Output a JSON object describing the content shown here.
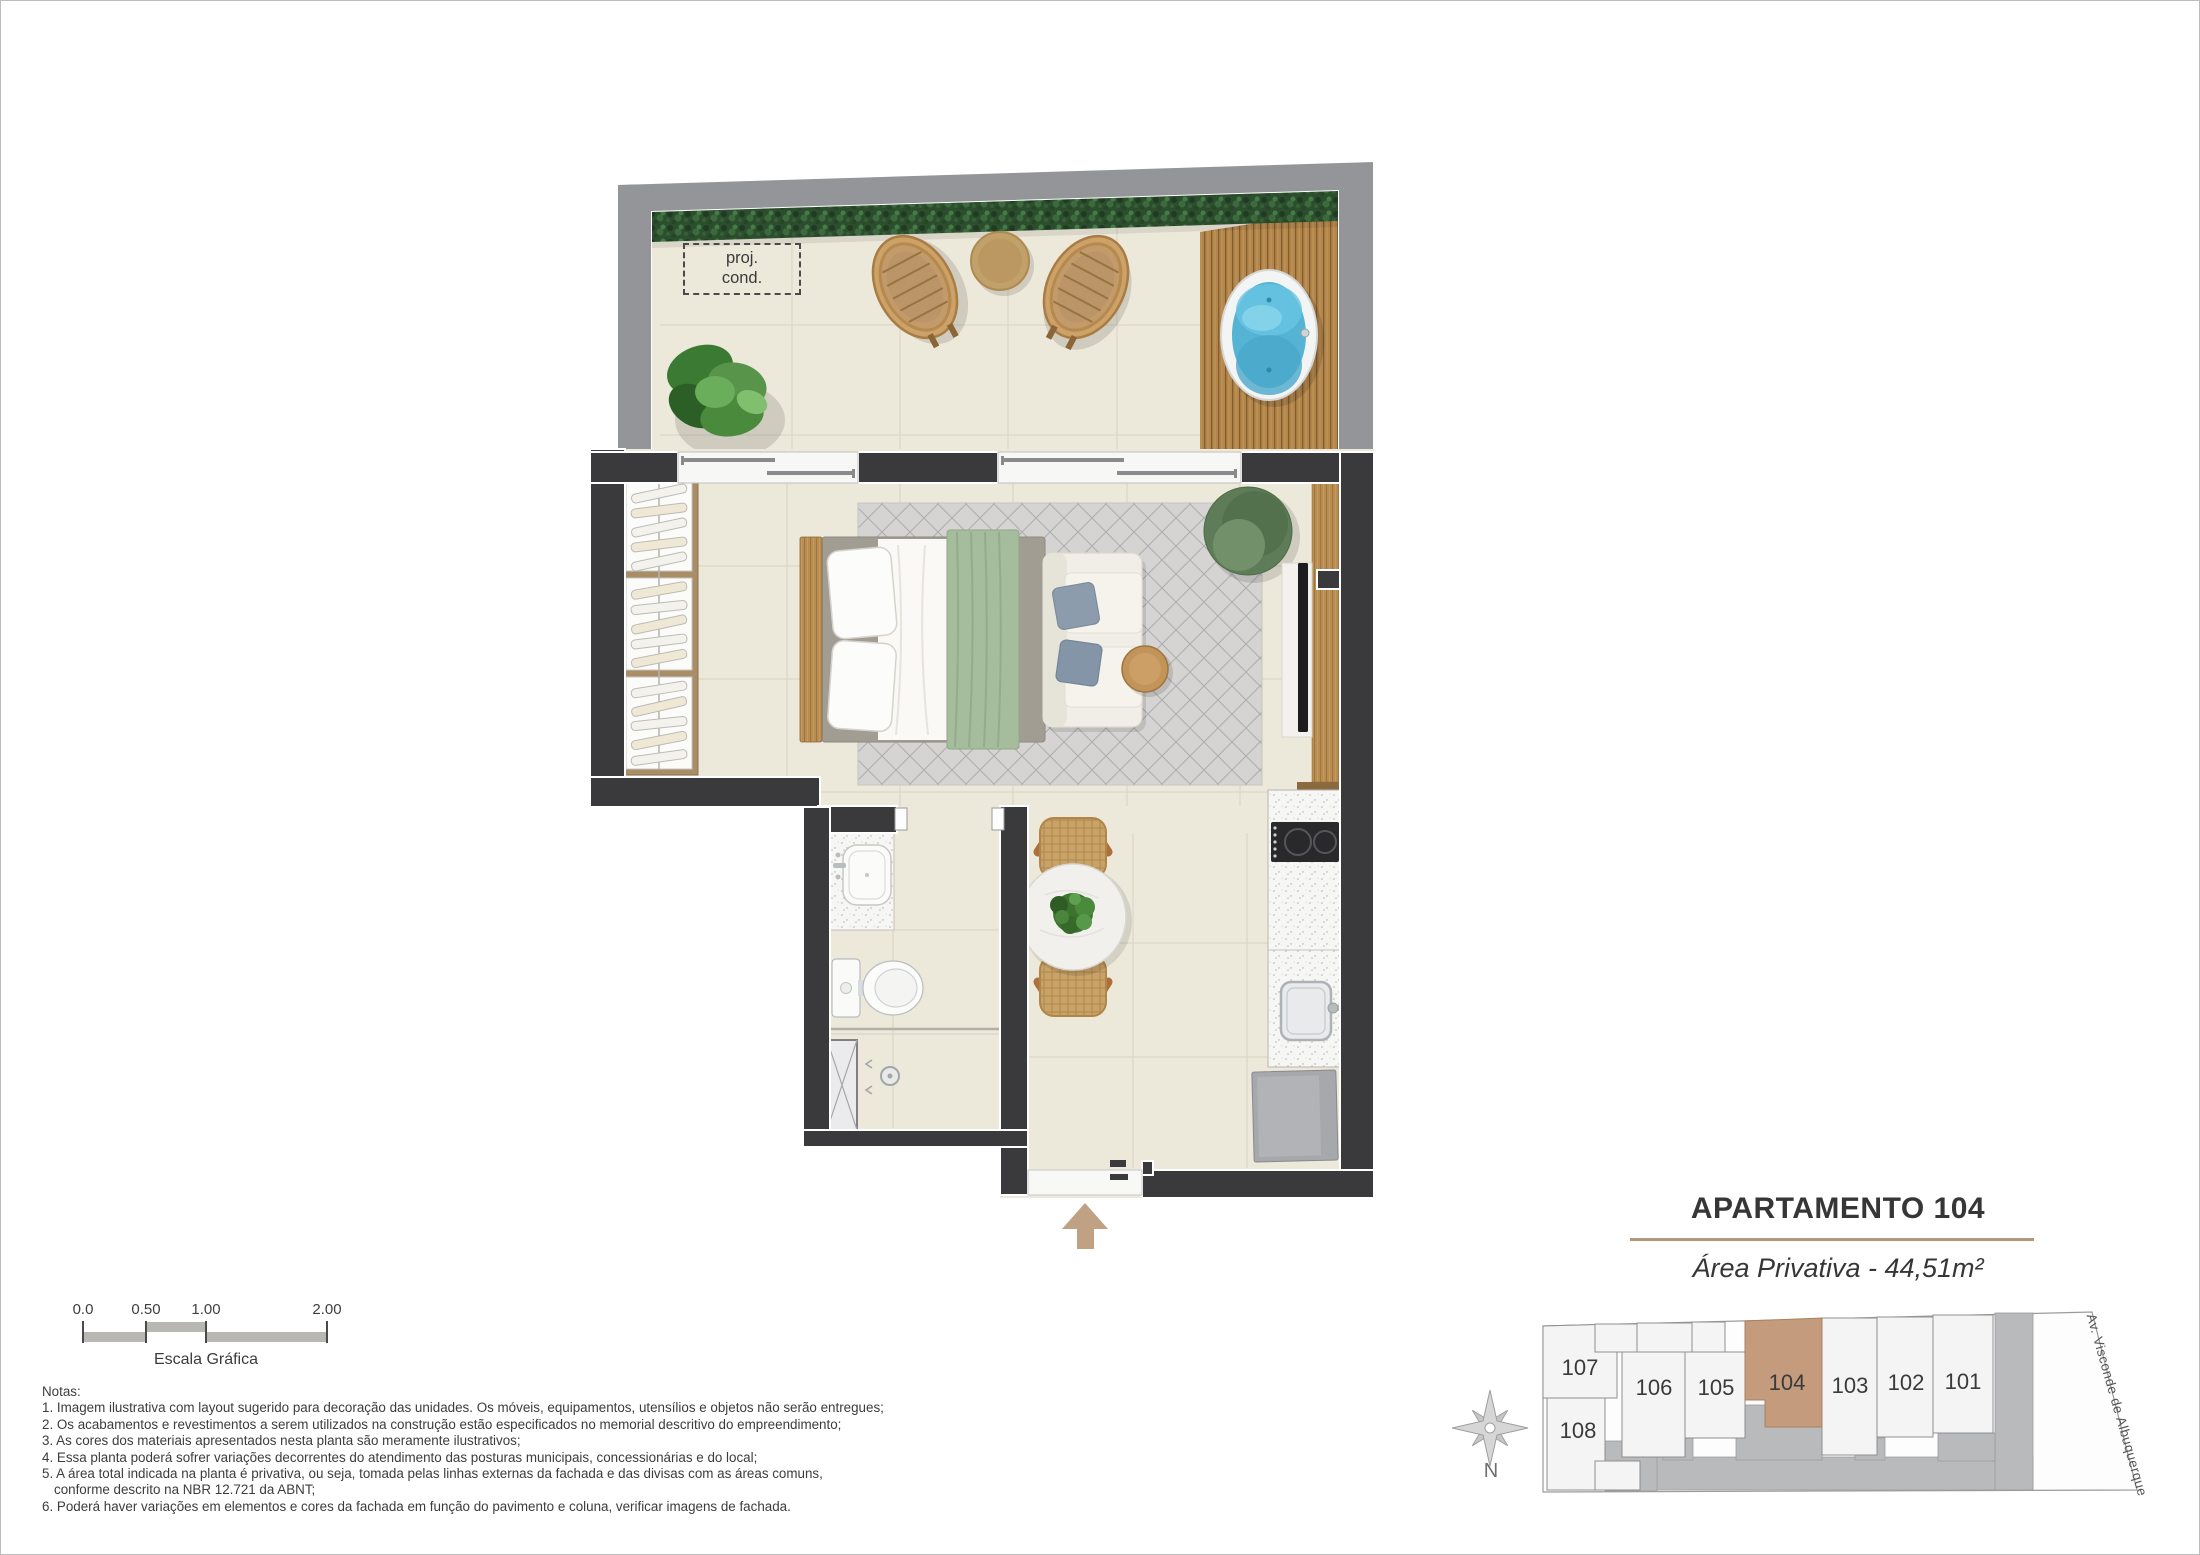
{
  "plan": {
    "proj_cond": {
      "line1": "proj.",
      "line2": "cond."
    }
  },
  "title_block": {
    "title": "APARTAMENTO 104",
    "subtitle": "Área Privativa - 44,51m²"
  },
  "keyplan": {
    "units": [
      {
        "label": "107"
      },
      {
        "label": "108"
      },
      {
        "label": "106"
      },
      {
        "label": "105"
      },
      {
        "label": "104"
      },
      {
        "label": "103"
      },
      {
        "label": "102"
      },
      {
        "label": "101"
      }
    ],
    "highlighted_unit": "104",
    "street_label": "Av. Visconde de Albuquerque",
    "compass_north_label": "N"
  },
  "scale_bar": {
    "tick_labels": [
      "0.0",
      "0.50",
      "1.00",
      "2.00"
    ],
    "caption": "Escala Gráfica"
  },
  "notes": {
    "heading": "Notas:",
    "lines": [
      "1. Imagem ilustrativa com layout sugerido para decoração das unidades. Os móveis, equipamentos, utensílios e objetos não serão entregues;",
      "2. Os acabamentos e revestimentos a serem utilizados na construção estão especificados no memorial descritivo do empreendimento;",
      "3. As cores dos materiais apresentados nesta planta são meramente ilustrativos;",
      "4. Essa planta poderá sofrer variações decorrentes do atendimento das posturas municipais, concessionárias e do local;",
      "5. A área total indicada na planta é privativa, ou seja, tomada pelas linhas externas da fachada e das divisas com as áreas comuns,",
      "conforme descrito na NBR 12.721 da ABNT;",
      "6. Poderá haver variações em elementos e cores da fachada em função do pavimento e coluna, verificar imagens de fachada."
    ]
  },
  "colors": {
    "wall": "#3a3a3c",
    "terrace_wall": "#939598",
    "floor": "#ece8da",
    "highlight_unit": "#c49b7d",
    "divider": "#b09879",
    "hedge": "#2c4e2e",
    "deck_wood": "#b3854a",
    "water": "#55b4d4",
    "rug": "#d5d4d2",
    "blanket": "#a5bc9d",
    "arrow": "#c0a183"
  }
}
